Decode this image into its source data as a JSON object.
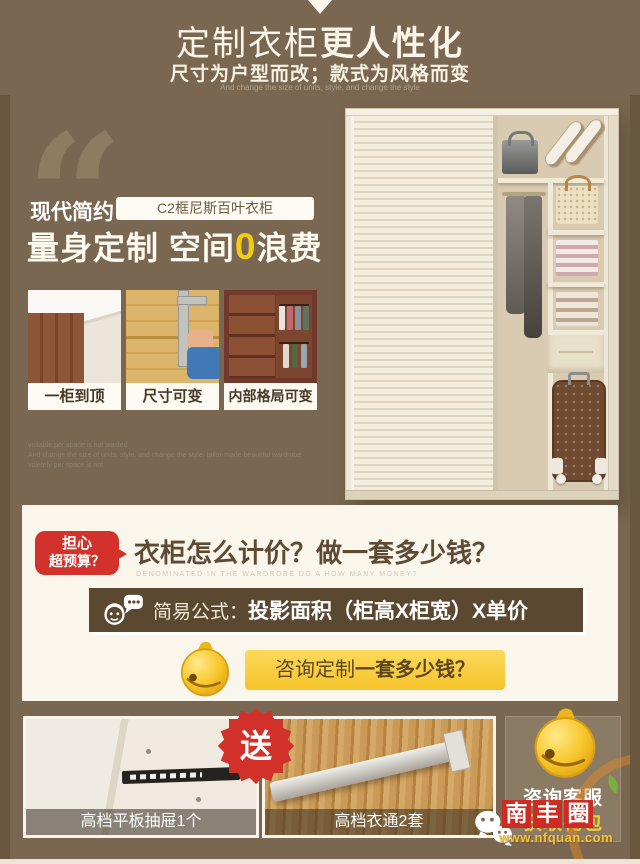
{
  "colors": {
    "background": "#796751",
    "frame": "#69583f",
    "cream_panel": "#faf6ec",
    "accent_red": "#d2322b",
    "accent_yellow": "#f5c32a",
    "formula_bar_brown": "#5a4830",
    "headline_zero_yellow": "#f3cc12",
    "logo_red": "#ce2b23",
    "url_yellow": "#eec43a"
  },
  "icons": {
    "down_arrow": "white triangle",
    "quote": "“",
    "bell": "gold cartoon bell",
    "customer_service": "headset face + speech bubble",
    "wechat": "chat bubbles",
    "free_burst": "16-point red star",
    "leaf": "green leaf"
  },
  "header": {
    "title_regular": "定制衣柜",
    "title_bold": "更人性化",
    "subtitle": "尺寸为户型而改；款式为风格而变",
    "subtitle_en": "And change the size of units, style, and change the style"
  },
  "hero": {
    "quote_glyph": "“",
    "style_label": "现代简约",
    "product_tag": "C2框尼斯百叶衣柜",
    "headline_pre": "量身定制 空间",
    "headline_zero": "0",
    "headline_post": "浪费",
    "features": [
      {
        "label": "一柜到顶"
      },
      {
        "label": "尺寸可变"
      },
      {
        "label": "内部格局可变"
      }
    ],
    "watermark_line1": "voitable per space is not wasted",
    "watermark_line2": "And change the size of units, style, and change the style, tailor-made beautiful wardrobe",
    "watermark_line3": "voletely per space is not"
  },
  "pricing": {
    "badge_line1": "担心",
    "badge_line2": "超预算？",
    "question": "衣柜怎么计价？做一套多少钱？",
    "question_en": "DENOMINATED IN THE WARDROBE DO A HOW MANY MONEY?",
    "formula_label": "简易公式：",
    "formula_value": "投影面积（柜高X柜宽）X单价",
    "consult_pre": "咨询定制",
    "consult_bold": "一套多少钱？"
  },
  "gifts": {
    "free_badge": "送",
    "items": [
      {
        "label": "高档平板抽屉1个"
      },
      {
        "label": "高档衣通2套"
      }
    ],
    "service_line1": "咨询客服",
    "service_line2": "获取礼包"
  },
  "watermark": {
    "logo_chars": [
      "南",
      "丰",
      "圈"
    ],
    "url": "www.nfquan.com"
  }
}
